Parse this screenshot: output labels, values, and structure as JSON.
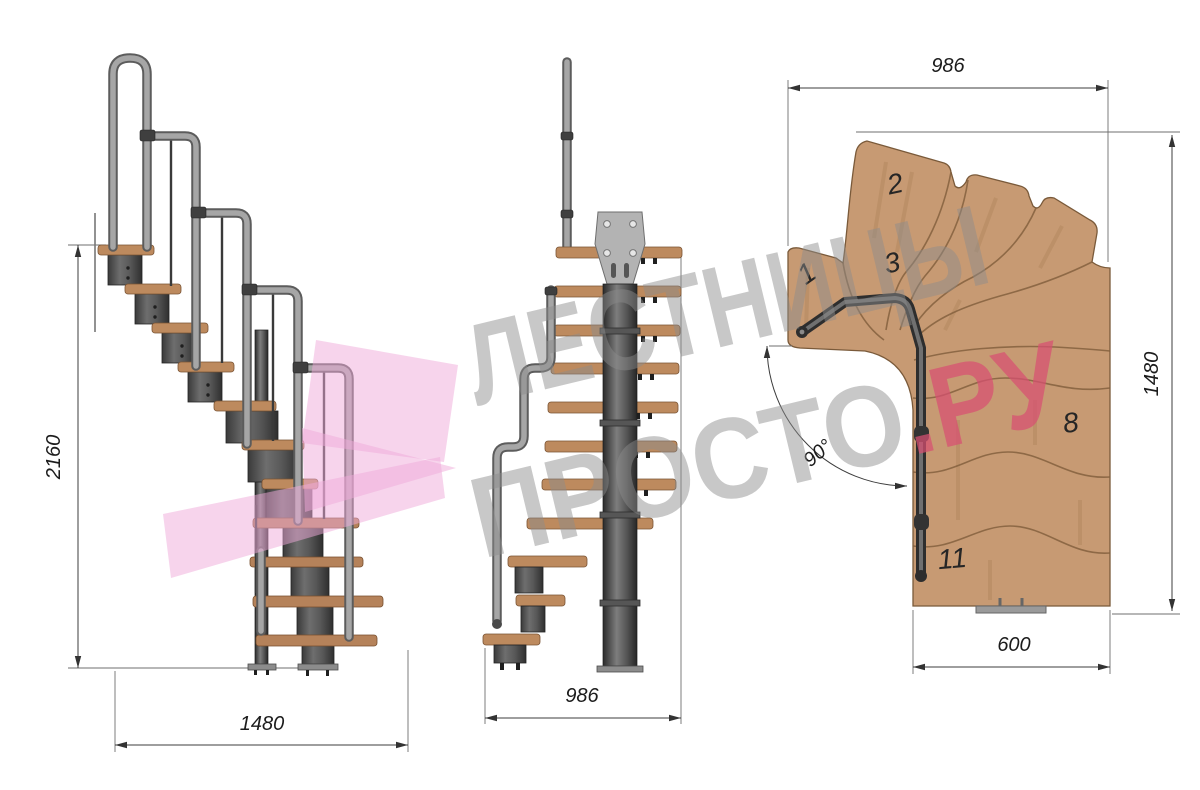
{
  "dimensions": {
    "side_view": {
      "height": "2160",
      "run": "1480"
    },
    "front_view": {
      "width": "986"
    },
    "plan_view": {
      "width": "986",
      "depth": "1480",
      "bottom_width": "600",
      "turn_angle": "90°"
    }
  },
  "tread_labels": {
    "t1": "1",
    "t2": "2",
    "t3": "3",
    "t8": "8",
    "t11": "11"
  },
  "watermark": {
    "line1": "ЛЕСТНИЦЫ",
    "line2": "ПРОСТО",
    "line2_accent": ".РУ"
  },
  "colors": {
    "background": "#ffffff",
    "wood_plan": "#c79a73",
    "wood_tread": "#bd8a5e",
    "wood_edge": "#7a5a3a",
    "metal_dark": "#4a4a4a",
    "rail_gray": "#a6a6a6",
    "plate_gray": "#b3b3b3",
    "dim_line": "#3c3c3c",
    "watermark_gray": "#8c8c8c",
    "watermark_pink": "#d84f72",
    "arrow_pink": "#efa9da"
  }
}
